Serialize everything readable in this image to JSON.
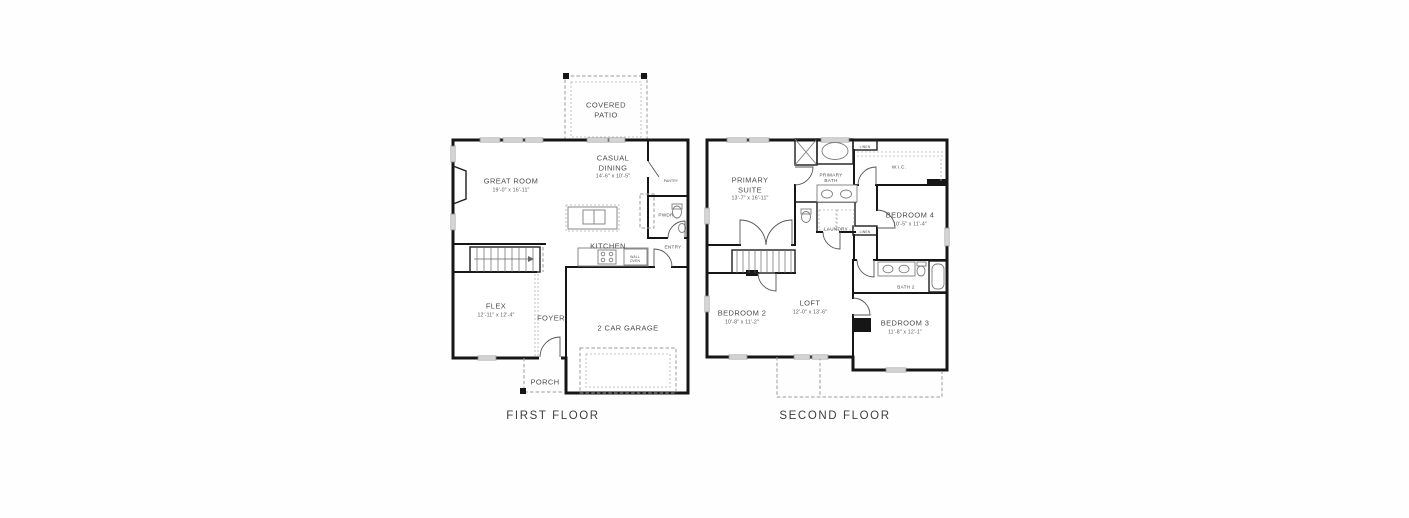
{
  "colors": {
    "wall": "#161616",
    "fixture": "#7d7d7d",
    "dashed": "#9b9b9b",
    "text": "#4c4c4c"
  },
  "first_floor": {
    "title": "FIRST FLOOR",
    "rooms": {
      "covered_patio": {
        "name": "COVERED\nPATIO"
      },
      "great_room": {
        "name": "GREAT ROOM",
        "dims": "19'-0\" x 16'-11\""
      },
      "casual_dining": {
        "name": "CASUAL\nDINING",
        "dims": "14'-6\" x 10'-5\""
      },
      "pantry": {
        "name": "PANTRY"
      },
      "powder": {
        "name": "PWDR"
      },
      "kitchen": {
        "name": "KITCHEN"
      },
      "entry": {
        "name": "ENTRY"
      },
      "wall_oven": {
        "name": "WALL\nOVEN"
      },
      "flex": {
        "name": "FLEX",
        "dims": "12'-11\" x 12'-4\""
      },
      "foyer": {
        "name": "FOYER"
      },
      "garage": {
        "name": "2 CAR GARAGE"
      },
      "porch": {
        "name": "PORCH"
      }
    }
  },
  "second_floor": {
    "title": "SECOND FLOOR",
    "rooms": {
      "primary_suite": {
        "name": "PRIMARY\nSUITE",
        "dims": "13'-7\" x 16'-11\""
      },
      "primary_bath": {
        "name": "PRIMARY\nBATH"
      },
      "linen_1": {
        "name": "LINEN"
      },
      "wic": {
        "name": "W.I.C."
      },
      "laundry": {
        "name": "LAUNDRY"
      },
      "linen_2": {
        "name": "LINEN"
      },
      "bedroom_4": {
        "name": "BEDROOM 4",
        "dims": "10'-5\" x 11'-4\""
      },
      "bath_2": {
        "name": "BATH 2"
      },
      "bedroom_2": {
        "name": "BEDROOM 2",
        "dims": "10'-8\" x 11'-2\""
      },
      "loft": {
        "name": "LOFT",
        "dims": "12'-0\" x 13'-6\""
      },
      "bedroom_3": {
        "name": "BEDROOM 3",
        "dims": "11'-8\" x 12'-1\""
      }
    }
  }
}
